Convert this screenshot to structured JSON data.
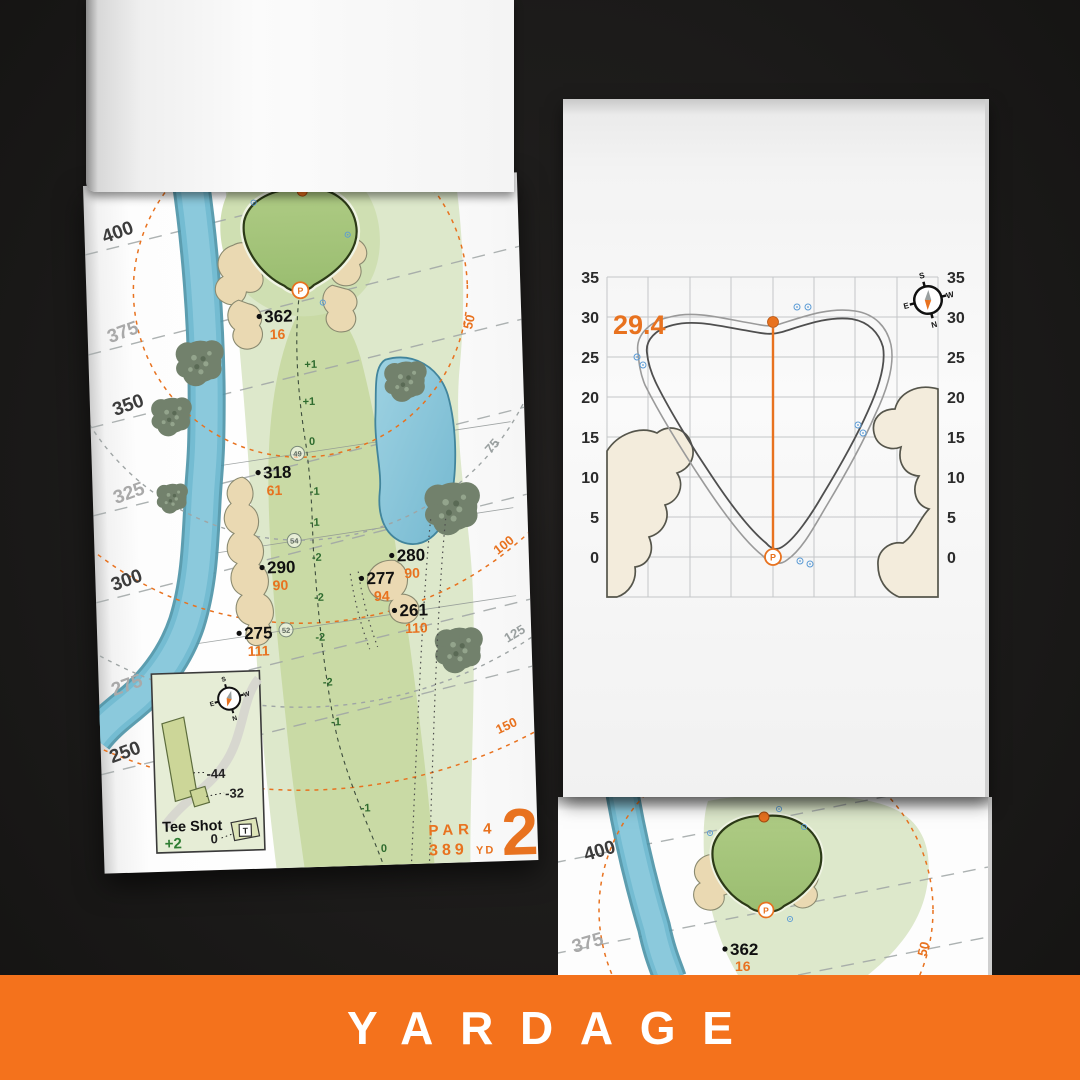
{
  "banner": {
    "label": "YARDAGE"
  },
  "colors": {
    "banner_orange": "#f4721c",
    "accent_orange": "#e8721f",
    "fairway_green": "#c9daa5",
    "putting_green": "#a5c57c",
    "water_blue": "#74bcd2",
    "sand": "#ead9b2",
    "elevation_green": "#2e6b2e"
  },
  "hole_page": {
    "hole_number": "2",
    "par_label": "PAR 4",
    "yards": "389",
    "yards_unit": "YD",
    "contour_labels": [
      "400",
      "375",
      "350",
      "325",
      "300",
      "275",
      "250"
    ],
    "arc_labels": [
      "50",
      "75",
      "100",
      "125",
      "150"
    ],
    "elevation_marks": [
      "+1",
      "+1",
      "0",
      "-1",
      "-1",
      "-2",
      "-2",
      "-2",
      "-2",
      "-1",
      "-1",
      "0"
    ],
    "sprinkler_numbers": [
      "49",
      "54",
      "52"
    ],
    "yardage_points": [
      {
        "dist": "362",
        "carry": "16"
      },
      {
        "dist": "318",
        "carry": "61"
      },
      {
        "dist": "290",
        "carry": "90"
      },
      {
        "dist": "280",
        "carry": "90"
      },
      {
        "dist": "277",
        "carry": "94"
      },
      {
        "dist": "261",
        "carry": "110"
      },
      {
        "dist": "275",
        "carry": "111"
      }
    ],
    "pin_label": "P",
    "inset": {
      "title": "Tee Shot",
      "score": "+2",
      "back_tee": "-44",
      "mid_tee": "-32",
      "front": "0",
      "tee_marker": "T"
    },
    "compass": {
      "n": "N",
      "s": "S",
      "e": "E",
      "w": "W"
    }
  },
  "green_page": {
    "carry_value": "29.4",
    "pin_label": "P",
    "axis_ticks_left": [
      "35",
      "30",
      "25",
      "20",
      "15",
      "10",
      "5",
      "0"
    ],
    "axis_ticks_right": [
      "35",
      "30",
      "25",
      "20",
      "15",
      "10",
      "5",
      "0"
    ],
    "compass": {
      "n": "N",
      "s": "S",
      "e": "E",
      "w": "W"
    },
    "chart_data": {
      "type": "map-grid",
      "y_ticks": [
        35,
        30,
        25,
        20,
        15,
        10,
        5,
        0
      ],
      "grid_step_yd": 5,
      "marked_depth": 29.4,
      "pin_depth": 0
    }
  },
  "under_page": {
    "contour_labels": [
      "400",
      "375"
    ],
    "arc_label": "50",
    "yardage_point": {
      "dist": "362",
      "carry": "16"
    },
    "pin_label": "P"
  }
}
